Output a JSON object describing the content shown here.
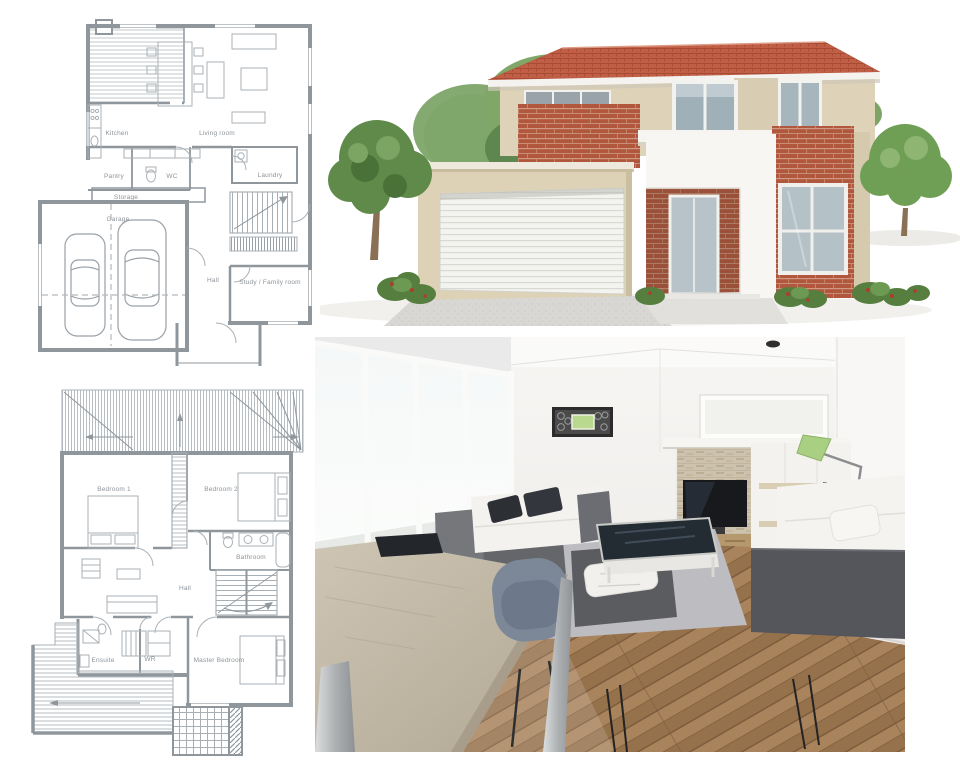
{
  "floor_plan_first": {
    "rooms": {
      "kitchen": "Kitchen",
      "living_room": "Living room",
      "pantry": "Pantry",
      "wc": "WC",
      "laundry": "Laundry",
      "storage": "Storage",
      "garage": "Garage",
      "hall": "Hall",
      "study": "Study / Family room"
    }
  },
  "floor_plan_second": {
    "rooms": {
      "bedroom1": "Bedroom 1",
      "bedroom2": "Bedroom 2",
      "bathroom": "Bathroom",
      "hall": "Hall",
      "ensuite": "Ensuite",
      "wr": "WR",
      "master_bedroom": "Master Bedroom"
    }
  },
  "palette": {
    "plan_wall": "#8f979d",
    "plan_furniture": "#aab1b6",
    "plan_text": "#8d949a",
    "roof_tile": "#c05f45",
    "brick": "#b0573e",
    "stucco": "#ddd1b6",
    "trim_white": "#f6f5f2",
    "foliage_green": "#5f8a49",
    "flower_red": "#b33b2e",
    "driveway_gray": "#d8d7d3",
    "interior_wall": "#f1efec",
    "sofa_dark_gray": "#55565b",
    "sofa_white": "#f3f2ef",
    "wood_floor": "#a5805a",
    "dining_table_wood": "#c3b9a8",
    "chair_blue_gray": "#7c8897",
    "lamp_green": "#a9cf82",
    "wall_art_green": "#b9d98f"
  }
}
